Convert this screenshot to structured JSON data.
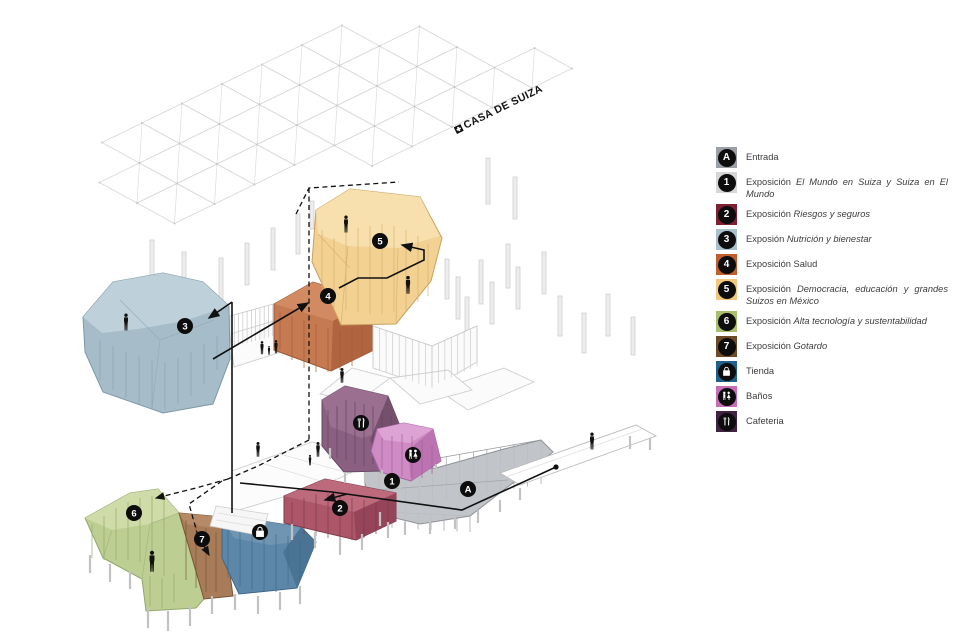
{
  "roof_label": {
    "text": "CASA DE SUIZA",
    "flag_icon": "swiss-flag-icon"
  },
  "legend": {
    "items": [
      {
        "symbol": "A",
        "icon": "",
        "color": "#9aa0a6",
        "prefix": "",
        "italic": "",
        "rest": "Entrada"
      },
      {
        "symbol": "1",
        "icon": "",
        "color": "#d4d6d8",
        "prefix": "Exposición ",
        "italic": "El Mundo en Suiza y Suiza en El Mundo",
        "rest": ""
      },
      {
        "symbol": "2",
        "icon": "",
        "color": "#7e2135",
        "prefix": "Exposición ",
        "italic": "Riesgos y seguros",
        "rest": ""
      },
      {
        "symbol": "3",
        "icon": "",
        "color": "#a9c1cb",
        "prefix": "Exposión ",
        "italic": "Nutrición y bienestar",
        "rest": ""
      },
      {
        "symbol": "4",
        "icon": "",
        "color": "#bf5f2e",
        "prefix": "Exposición ",
        "italic": "",
        "rest": "Salud"
      },
      {
        "symbol": "5",
        "icon": "",
        "color": "#f2c87c",
        "prefix": "Exposición ",
        "italic": "Democracia, educación y grandes Suizos en México",
        "rest": ""
      },
      {
        "symbol": "6",
        "icon": "",
        "color": "#a9bf6e",
        "prefix": "Exposición ",
        "italic": "Alta tecnología y sustentabilidad",
        "rest": ""
      },
      {
        "symbol": "7",
        "icon": "",
        "color": "#6d4b27",
        "prefix": "Exposición ",
        "italic": "Gotardo",
        "rest": ""
      },
      {
        "symbol": "",
        "icon": "shopping-bag",
        "color": "#20608a",
        "prefix": "",
        "italic": "",
        "rest": "Tienda"
      },
      {
        "symbol": "",
        "icon": "restroom",
        "color": "#c66db5",
        "prefix": "",
        "italic": "",
        "rest": "Baños"
      },
      {
        "symbol": "",
        "icon": "utensils",
        "color": "#3f2340",
        "prefix": "",
        "italic": "",
        "rest": "Cafeteria"
      }
    ]
  },
  "diagram": {
    "markers": {
      "mA": "A",
      "m1": "1",
      "m2": "2",
      "m3": "3",
      "m4": "4",
      "m5": "5",
      "m6": "6",
      "m7": "7"
    }
  }
}
